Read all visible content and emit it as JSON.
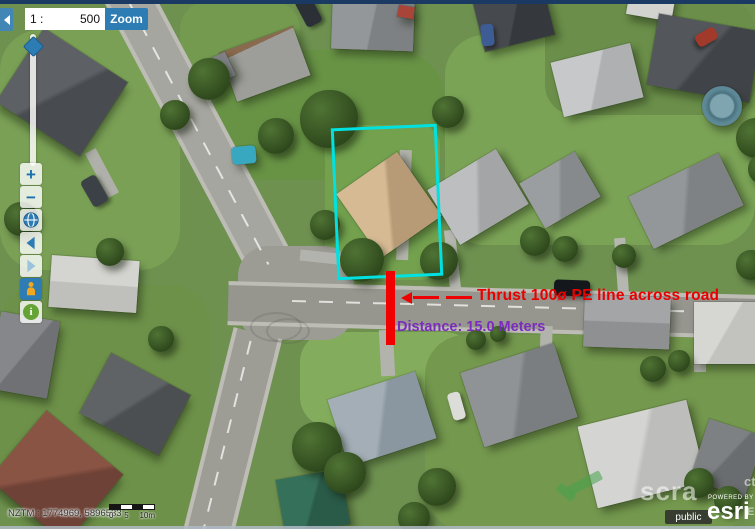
{
  "header": {
    "scale_prefix": "1 :",
    "scale_value": "500",
    "zoom_button_label": "Zoom"
  },
  "toolbar": {
    "zoom_in_label": "+",
    "zoom_out_label": "−"
  },
  "annotations": {
    "thrust_label": "Thrust 100ø PE line across road",
    "distance_label": "Distance: 15.0 Meters",
    "colors": {
      "parcel_outline": "#00e1e1",
      "thrust_line": "#f00100",
      "thrust_text": "#e90000",
      "distance_text": "#7b2cbf"
    }
  },
  "statusbar": {
    "coordinates": "NZTM : 1774969, 5896533",
    "scalebar_labels": [
      "0",
      "5",
      "10m"
    ]
  },
  "attribution": {
    "badge": "public",
    "powered_by": "POWERED BY",
    "brand": "esri"
  },
  "watermark": {
    "text": "scra",
    "fragment_top": "ct",
    "fragment_bottom": "EL"
  },
  "map_scene": {
    "lawns": [
      {
        "x": 0,
        "y": 30,
        "w": 180,
        "h": 240,
        "bg": "#7aa055",
        "br": 40
      },
      {
        "x": 215,
        "y": 50,
        "w": 230,
        "h": 130,
        "bg": "#689345",
        "br": 50
      },
      {
        "x": 325,
        "y": 125,
        "w": 115,
        "h": 155,
        "bg": "#73a14e",
        "br": 20
      },
      {
        "x": 445,
        "y": 35,
        "w": 310,
        "h": 210,
        "bg": "#7ba356",
        "br": 40
      },
      {
        "x": 300,
        "y": 332,
        "w": 175,
        "h": 95,
        "bg": "#83ad5c",
        "br": 30
      },
      {
        "x": 0,
        "y": 285,
        "w": 210,
        "h": 245,
        "bg": "#6d9149",
        "br": 40
      },
      {
        "x": 425,
        "y": 335,
        "w": 330,
        "h": 195,
        "bg": "#74984e",
        "br": 40
      },
      {
        "x": 545,
        "y": 0,
        "w": 210,
        "h": 115,
        "bg": "#6b8f4a",
        "br": 30
      },
      {
        "x": 180,
        "y": 0,
        "w": 120,
        "h": 70,
        "bg": "#749a50",
        "br": 30
      }
    ],
    "roads": [
      {
        "x": 178,
        "y": -30,
        "w": 40,
        "h": 330,
        "rot": -28,
        "bg": "#a6a6a0",
        "o": "v"
      },
      {
        "x": 238,
        "y": 246,
        "w": 116,
        "h": 94,
        "bg": "#9c9c95",
        "br": 30
      },
      {
        "x": 228,
        "y": 288,
        "w": 527,
        "h": 36,
        "rot": 1.5,
        "bg": "#96968f",
        "o": "h"
      },
      {
        "x": 207,
        "y": 330,
        "w": 42,
        "h": 215,
        "rot": 14,
        "bg": "#9d9d96",
        "o": "v"
      }
    ],
    "centerlines": [
      {
        "x": 197,
        "y": -18,
        "w": 2,
        "h": 300,
        "rot": -28,
        "o": "v"
      },
      {
        "x": 292,
        "y": 306,
        "w": 460,
        "h": 2,
        "rot": 1.5,
        "o": "h"
      },
      {
        "x": 226,
        "y": 338,
        "w": 2,
        "h": 195,
        "rot": 14,
        "o": "v"
      }
    ],
    "driveways": [
      {
        "x": 380,
        "y": 330,
        "w": 14,
        "h": 46,
        "rot": -3,
        "bg": "#b3b3ad"
      },
      {
        "x": 447,
        "y": 230,
        "w": 11,
        "h": 60,
        "rot": -6,
        "bg": "#b7b7b1"
      },
      {
        "x": 300,
        "y": 252,
        "w": 48,
        "h": 11,
        "rot": 6,
        "bg": "#b3b3ad"
      },
      {
        "x": 616,
        "y": 238,
        "w": 11,
        "h": 54,
        "rot": -4,
        "bg": "#b7b7b1"
      },
      {
        "x": 96,
        "y": 148,
        "w": 12,
        "h": 50,
        "rot": -28,
        "bg": "#b0b0aa"
      },
      {
        "x": 540,
        "y": 326,
        "w": 12,
        "h": 42,
        "rot": 2,
        "bg": "#b3b3ad"
      },
      {
        "x": 694,
        "y": 330,
        "w": 12,
        "h": 42,
        "rot": 0,
        "bg": "#b3b3ad"
      },
      {
        "x": 398,
        "y": 150,
        "w": 12,
        "h": 110,
        "rot": 2,
        "bg": "#b5b5ae"
      }
    ],
    "houses": [
      {
        "x": 12,
        "y": 48,
        "w": 100,
        "h": 88,
        "rot": 33,
        "bg": "linear-gradient(120deg,#5d6064 48%,#484b4f 52%)"
      },
      {
        "x": 226,
        "y": 38,
        "w": 78,
        "h": 52,
        "rot": -20,
        "bg": "linear-gradient(175deg,#8a6a4e 14%,#9d9d9a 14%)"
      },
      {
        "x": 196,
        "y": 58,
        "w": 36,
        "h": 26,
        "rot": -25,
        "bg": "#7e8184"
      },
      {
        "x": 332,
        "y": -8,
        "w": 82,
        "h": 58,
        "rot": 2,
        "bg": "linear-gradient(100deg,#94979a 49%,#7e8184 51%)"
      },
      {
        "x": 398,
        "y": 6,
        "w": 16,
        "h": 12,
        "rot": 10,
        "bg": "#a84438"
      },
      {
        "x": 478,
        "y": -6,
        "w": 72,
        "h": 50,
        "rot": -14,
        "bg": "linear-gradient(115deg,#46494d 49%,#35383c 51%)"
      },
      {
        "x": 556,
        "y": 52,
        "w": 82,
        "h": 56,
        "rot": -14,
        "bg": "linear-gradient(115deg,#c6c8ca 49%,#aeb0b2 51%)"
      },
      {
        "x": 628,
        "y": -10,
        "w": 46,
        "h": 28,
        "rot": 10,
        "bg": "#d2d2cf"
      },
      {
        "x": 652,
        "y": 22,
        "w": 104,
        "h": 72,
        "rot": 10,
        "bg": "linear-gradient(120deg,#53565a 48%,#404347 52%)"
      },
      {
        "x": 702,
        "y": 86,
        "w": 40,
        "h": 40,
        "br": 50,
        "bg": "radial-gradient(circle at 50% 50%,#7fa6b0 40%,#49707e 46%,#5d8896 60%)"
      },
      {
        "x": 232,
        "y": 146,
        "w": 24,
        "h": 18,
        "rot": -5,
        "br": 4,
        "bg": "#38a8c0"
      },
      {
        "x": 50,
        "y": 258,
        "w": 88,
        "h": 52,
        "rot": 4,
        "bg": "linear-gradient(180deg,#d4d4d0 49%,#bfbfbb 51%)"
      },
      {
        "x": -6,
        "y": 316,
        "w": 60,
        "h": 78,
        "rot": 10,
        "bg": "linear-gradient(120deg,#85878a 49%,#6f7174 51%)"
      },
      {
        "x": 90,
        "y": 370,
        "w": 90,
        "h": 68,
        "rot": 28,
        "bg": "linear-gradient(120deg,#606366 48%,#4c4f52 52%)"
      },
      {
        "x": 6,
        "y": 432,
        "w": 100,
        "h": 90,
        "rot": 40,
        "bg": "linear-gradient(130deg,#8a5444 48%,#6e4236 52%)"
      },
      {
        "x": 352,
        "y": 166,
        "w": 74,
        "h": 78,
        "rot": -35,
        "bg": "linear-gradient(120deg,#d6ba94 48%,#b79b76 52%)"
      },
      {
        "x": 438,
        "y": 165,
        "w": 80,
        "h": 64,
        "rot": -31,
        "bg": "linear-gradient(120deg,#bcbec0 48%,#a3a5a7 52%)"
      },
      {
        "x": 528,
        "y": 164,
        "w": 64,
        "h": 52,
        "rot": -30,
        "bg": "linear-gradient(120deg,#9b9ea0 48%,#868a8c 52%)"
      },
      {
        "x": 636,
        "y": 172,
        "w": 100,
        "h": 58,
        "rot": -26,
        "bg": "linear-gradient(120deg,#94979a 48%,#7f8285 52%)"
      },
      {
        "x": 584,
        "y": 296,
        "w": 86,
        "h": 52,
        "rot": 2,
        "bg": "linear-gradient(180deg,#a3a5a7 49%,#8e9092 51%)"
      },
      {
        "x": 694,
        "y": 302,
        "w": 62,
        "h": 62,
        "rot": 0,
        "bg": "linear-gradient(120deg,#d6d6d3 49%,#c2c2bf 51%)"
      },
      {
        "x": 336,
        "y": 384,
        "w": 92,
        "h": 70,
        "rot": -18,
        "bg": "linear-gradient(115deg,#a3aeb6 48%,#8b97a0 52%)"
      },
      {
        "x": 470,
        "y": 356,
        "w": 98,
        "h": 78,
        "rot": -18,
        "bg": "linear-gradient(115deg,#909396 48%,#7b7e81 52%)"
      },
      {
        "x": 586,
        "y": 412,
        "w": 112,
        "h": 84,
        "rot": -14,
        "bg": "linear-gradient(115deg,#d4d5d2 48%,#bdbebb 52%)"
      },
      {
        "x": 280,
        "y": 474,
        "w": 66,
        "h": 56,
        "rot": -10,
        "bg": "linear-gradient(115deg,#35705a 48%,#2a5a48 52%)"
      },
      {
        "x": 698,
        "y": 426,
        "w": 58,
        "h": 64,
        "rot": 18,
        "bg": "linear-gradient(115deg,#7e8184 48%,#6a6d70 52%)"
      }
    ],
    "trees": [
      {
        "x": 300,
        "y": 90,
        "d": 58
      },
      {
        "x": 258,
        "y": 118,
        "d": 36
      },
      {
        "x": 188,
        "y": 58,
        "d": 42
      },
      {
        "x": 160,
        "y": 100,
        "d": 30
      },
      {
        "x": 432,
        "y": 96,
        "d": 32
      },
      {
        "x": 340,
        "y": 238,
        "d": 44
      },
      {
        "x": 420,
        "y": 242,
        "d": 38
      },
      {
        "x": 310,
        "y": 210,
        "d": 30
      },
      {
        "x": 520,
        "y": 226,
        "d": 30
      },
      {
        "x": 552,
        "y": 236,
        "d": 26
      },
      {
        "x": 612,
        "y": 244,
        "d": 24
      },
      {
        "x": 292,
        "y": 422,
        "d": 50
      },
      {
        "x": 324,
        "y": 452,
        "d": 42
      },
      {
        "x": 418,
        "y": 468,
        "d": 38
      },
      {
        "x": 398,
        "y": 502,
        "d": 32
      },
      {
        "x": 736,
        "y": 118,
        "d": 40
      },
      {
        "x": 748,
        "y": 154,
        "d": 30
      },
      {
        "x": 640,
        "y": 356,
        "d": 26
      },
      {
        "x": 668,
        "y": 350,
        "d": 22
      },
      {
        "x": 684,
        "y": 468,
        "d": 30
      },
      {
        "x": 714,
        "y": 486,
        "d": 28
      },
      {
        "x": 96,
        "y": 238,
        "d": 28
      },
      {
        "x": 148,
        "y": 326,
        "d": 26
      },
      {
        "x": 4,
        "y": 202,
        "d": 34
      },
      {
        "x": 466,
        "y": 330,
        "d": 20
      },
      {
        "x": 490,
        "y": 326,
        "d": 16
      },
      {
        "x": 736,
        "y": 250,
        "d": 30
      }
    ],
    "cars": [
      {
        "x": 300,
        "y": -4,
        "w": 17,
        "h": 30,
        "rot": -28,
        "bg": "#2b2f36"
      },
      {
        "x": 86,
        "y": 176,
        "w": 17,
        "h": 30,
        "rot": -30,
        "bg": "#3c4148"
      },
      {
        "x": 554,
        "y": 280,
        "w": 36,
        "h": 16,
        "rot": 2,
        "bg": "#14171c"
      },
      {
        "x": 481,
        "y": 24,
        "w": 13,
        "h": 22,
        "rot": -5,
        "bg": "#3d5c94"
      },
      {
        "x": 700,
        "y": 26,
        "w": 13,
        "h": 22,
        "rot": 60,
        "bg": "#a23a2c"
      },
      {
        "x": 450,
        "y": 392,
        "w": 13,
        "h": 28,
        "rot": -16,
        "bg": "#dcdcd8"
      }
    ]
  }
}
